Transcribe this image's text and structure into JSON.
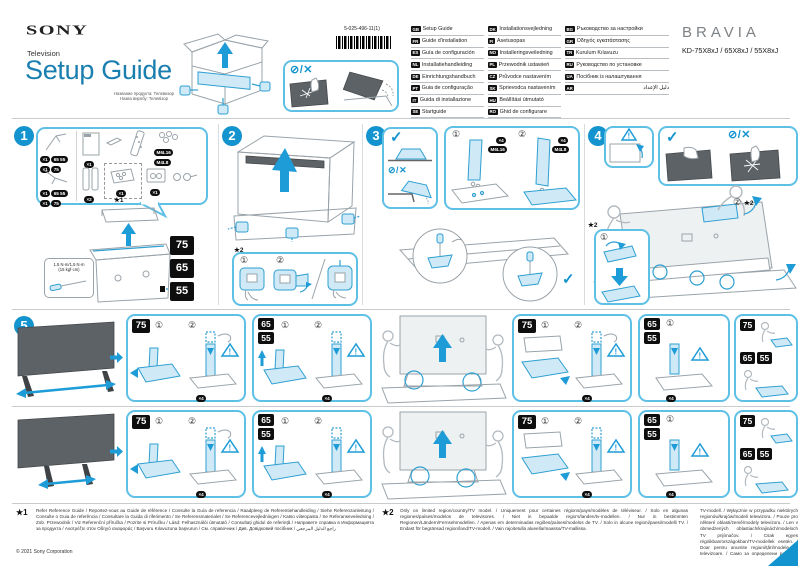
{
  "header": {
    "brand": "SONY",
    "product_type": "Television",
    "title": "Setup Guide",
    "subtitle_line1": "Название продукта: Телевизор",
    "subtitle_line2": "Назва виробу: Телевізор",
    "part_number": "5-025-496-11(1)",
    "bravia": "BRAVIA",
    "models": "KD-75X8xJ / 65X8xJ / 55X8xJ"
  },
  "icons": {
    "check": "✓",
    "prohibit": "⊘",
    "slash": "/",
    "cross": "✕",
    "warning_mark": "!"
  },
  "sizes": {
    "s75": "75",
    "s65": "65",
    "s55": "55",
    "s6555": "65 55"
  },
  "steps": {
    "n1": "1",
    "n2": "2",
    "n3": "3",
    "n4": "4",
    "n5": "5"
  },
  "marks": {
    "c1": "①",
    "c2": "②",
    "star1": "★1",
    "star2": "★2"
  },
  "languages": {
    "col1": [
      {
        "code": "GB",
        "label": "Setup Guide"
      },
      {
        "code": "FR",
        "label": "Guide d'installation"
      },
      {
        "code": "ES",
        "label": "Guía de configuración"
      },
      {
        "code": "NL",
        "label": "Installatiehandleiding"
      },
      {
        "code": "DE",
        "label": "Einrichtungshandbuch"
      },
      {
        "code": "PT",
        "label": "Guia de configuração"
      },
      {
        "code": "IT",
        "label": "Guida di installazione"
      },
      {
        "code": "SE",
        "label": "Startguide"
      }
    ],
    "col2": [
      {
        "code": "DK",
        "label": "Installationsvejledning"
      },
      {
        "code": "FI",
        "label": "Asetusopas"
      },
      {
        "code": "NO",
        "label": "Installeringsveiledning"
      },
      {
        "code": "PL",
        "label": "Przewodnik ustawień"
      },
      {
        "code": "CZ",
        "label": "Průvodce nastavením"
      },
      {
        "code": "SK",
        "label": "Sprievodca nastavením"
      },
      {
        "code": "HU",
        "label": "Beállítási útmutató"
      },
      {
        "code": "RO",
        "label": "Ghid de configurare"
      }
    ],
    "col3": [
      {
        "code": "BG",
        "label": "Ръководство за настройки"
      },
      {
        "code": "GR",
        "label": "Οδηγός εγκατάστασης"
      },
      {
        "code": "TR",
        "label": "Kurulum Kılavuzu"
      },
      {
        "code": "RU",
        "label": "Руководство по установке"
      },
      {
        "code": "UA",
        "label": "Посібник із налаштування"
      },
      {
        "code": "AR",
        "label": "دليل الإعداد"
      }
    ]
  },
  "step1": {
    "badges": {
      "leg_qty": "×1",
      "doc_qty": "×1",
      "neck_qty": "×2",
      "bag_qty": "×1",
      "rings_qty": "×1",
      "screw1": "M6L16",
      "screw2": "M4L8"
    },
    "torque_line1": "1.5 N·m/1,5 N·m",
    "torque_line2": "(15 kgf·cm)"
  },
  "step3": {
    "qty": "×4",
    "screw1": "M6L16",
    "screw2": "M4L8"
  },
  "step5": {
    "qty": "×4"
  },
  "footnotes": {
    "ref1_marker": "★1",
    "ref1_text": "Refer Reference Guide / Reportez-vous au Guide de référence / Consulte la Guía de referencia / Raadpleeg de Referentiehandleiding / Siehe Referenzanleitung / Consulte o Guia de referência / Consultare la Guida di riferimento / Se Referensmaterialet / Se Referencevejledningen / Katso viiteopasta / Se Referanseveiledning / Zob. Przewodnik / Viz Referenční příručka / Pozrite si Príručku / Lásd: Felhasználói útmutató / Consultați ghidul de referință / Направете справка в Информацията за продукта / Ανατρέξτε στον Οδηγό αναφοράς / Başvuru Kılavuzuna başvurun / См. справочник / Див. Довідковий посібник / راجع الدليل المرجعي",
    "ref2_marker": "★2",
    "ref2_text": "Only on limited region/country/TV model. / Uniquement pour certaines régions/pays/modèles de téléviseur. / Solo en algunas regiones/países/modelos de televisores. / Niet in bepaalde regio's/landen/tv-modellen. / Nur in bestimmten Regionen/Ländern/Fernsehmodellen. / Apenas em determinadas regiões/países/modelos de TV. / Solo in alcune regioni/paesi/modelli TV. / Endast för begränsad region/land/TV-modell. / Vain rajoitetulla alueella/maassa/TV-mallissa.",
    "ref2_cont": "TV-modell. / Wyłącznie w przypadku niektórych regionów/krajów/modeli telewizora. / Pouze pro některé oblasti/země/modely televizoru. / Len v obmedzených oblastiach/krajinách/modeloch TV prijímačov. / Csak egyes régiókban/országokban/TV-modellek esetén. / Doar pentru anumite regiuni/țări/modele de televizoare. / Само за определени региони/държави/модели телевизори. / Μόνο σε περιορισμένη περιοχή/χώρα/μοντέλο τηλεόρασης. / Yalnızca sınırlı bölge/ülke/TV modeli için. / Только для некоторых регионов/стран/моделей телевизоров. / Лише для окремих регіонів/країн/моделей телевізорів.",
    "copyright": "© 2021 Sony Corporation"
  }
}
